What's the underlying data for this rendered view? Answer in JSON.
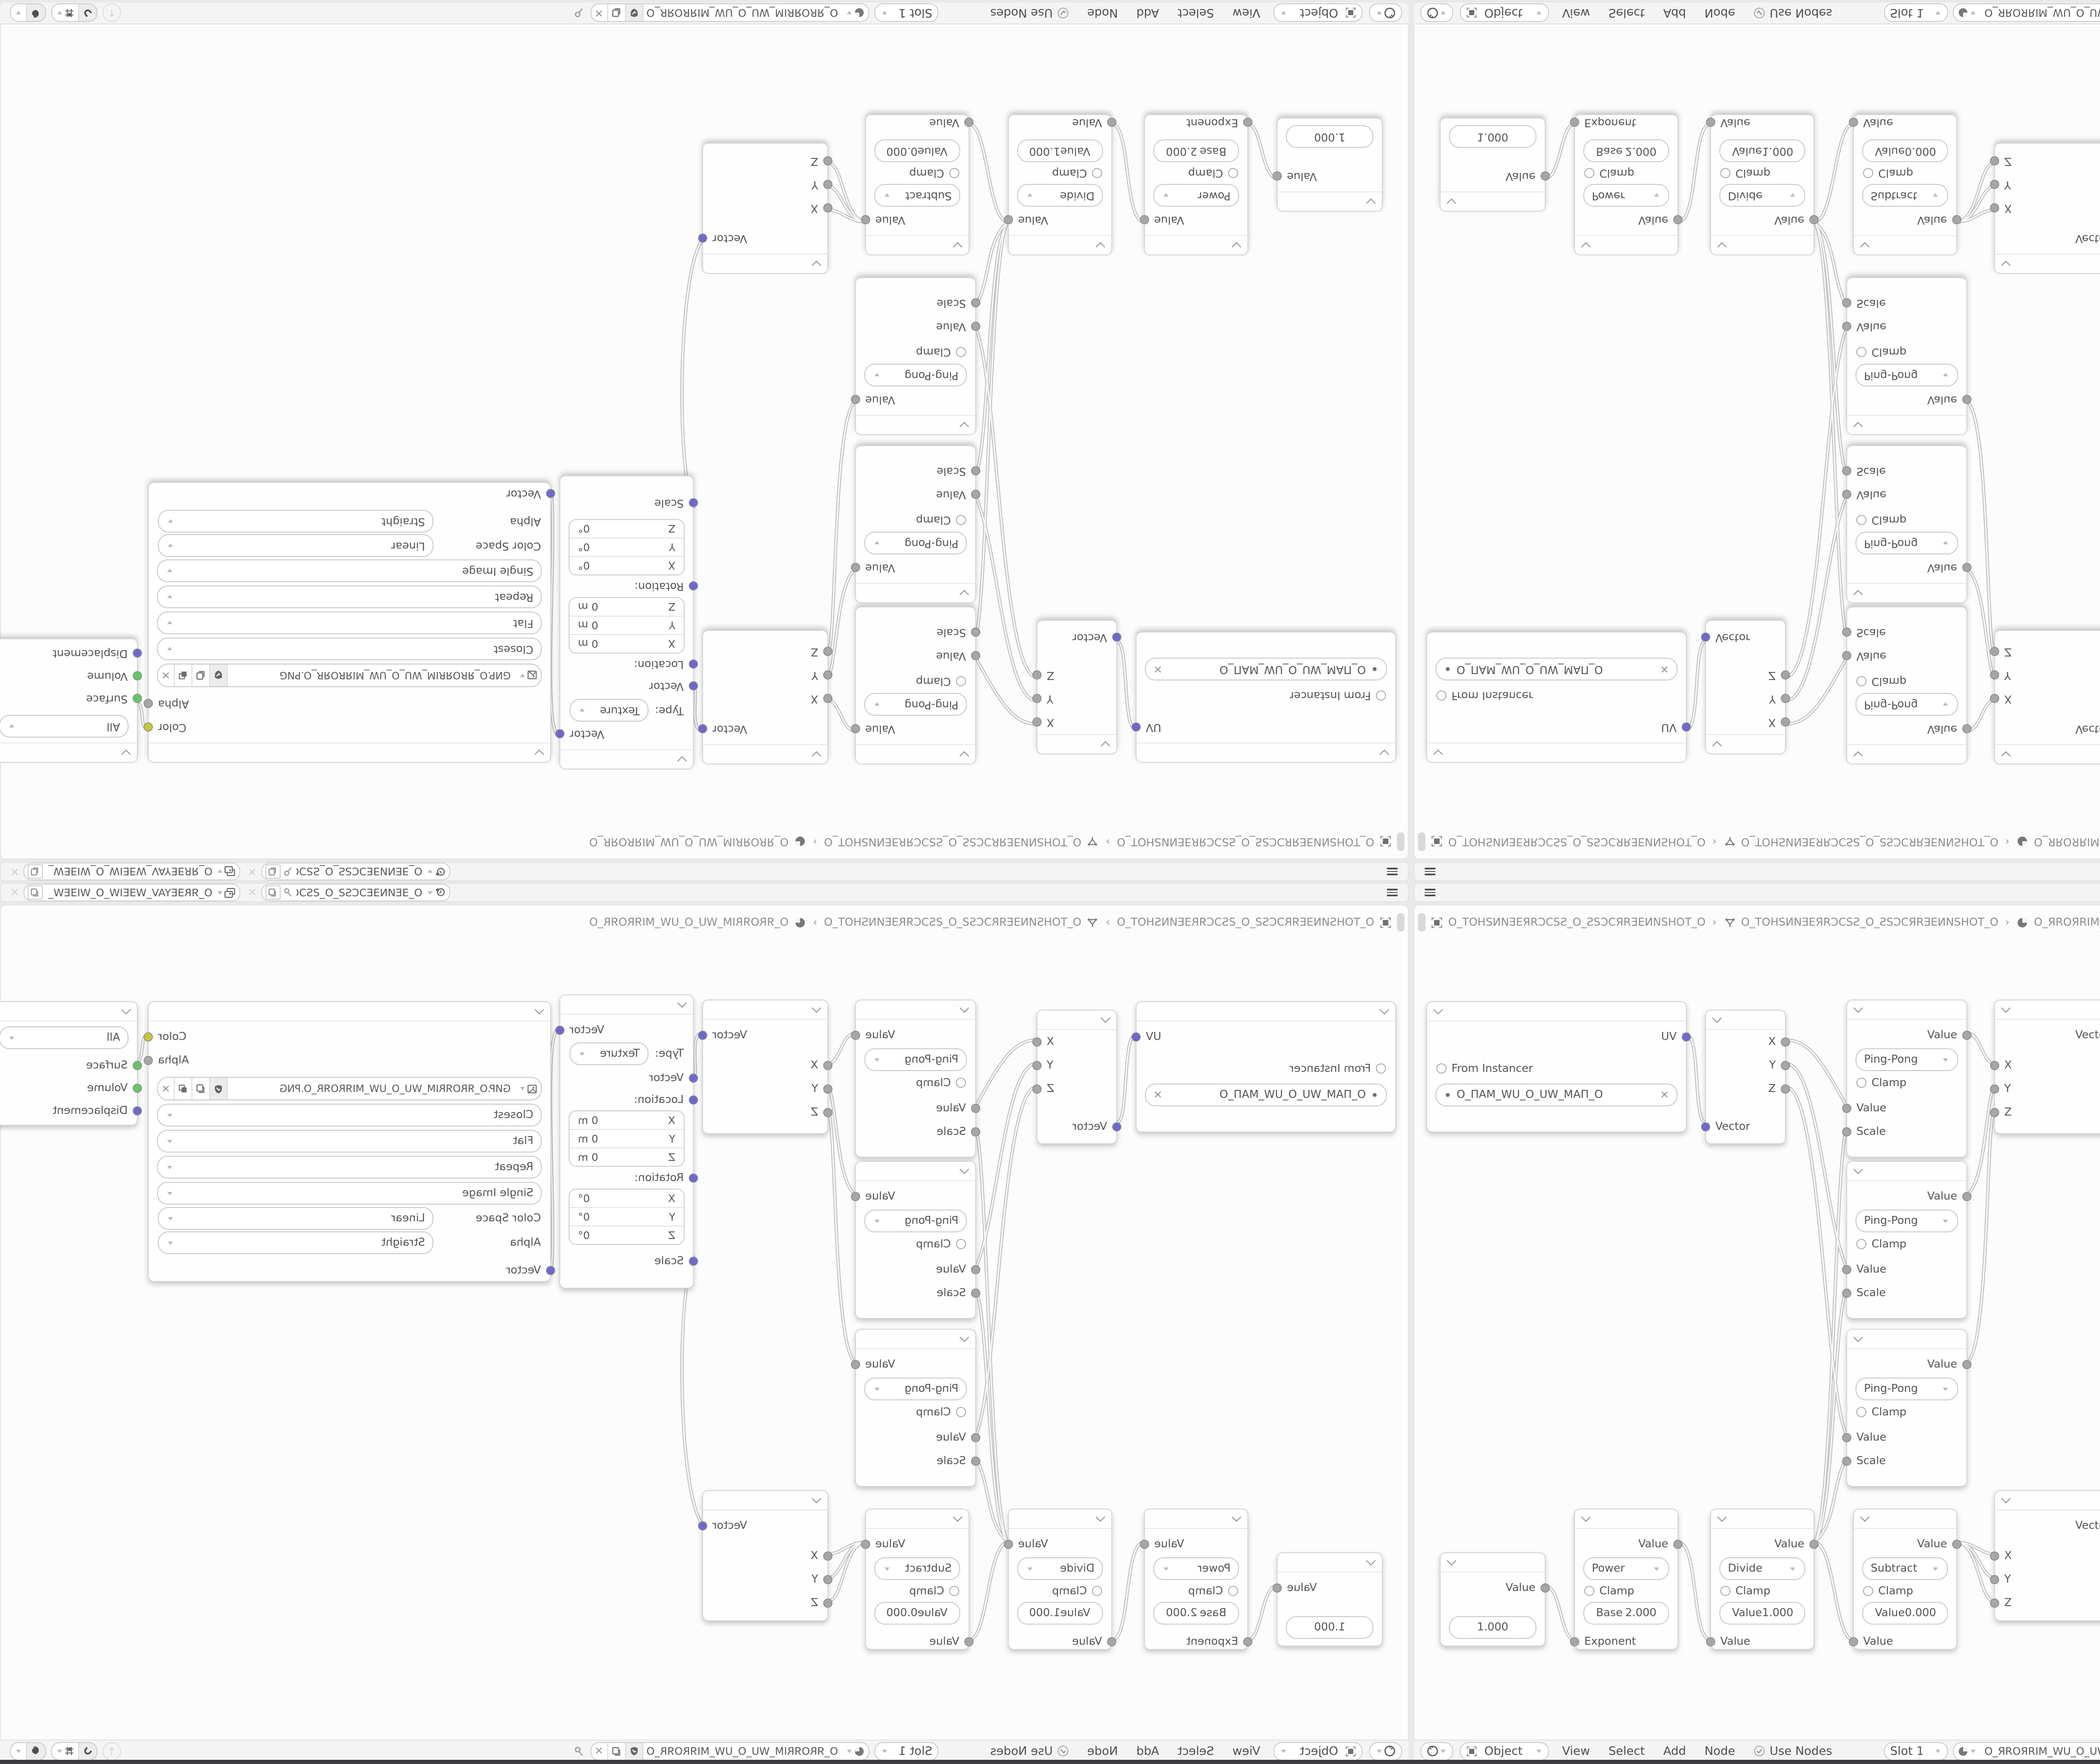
{
  "window": {
    "bottom_edge_color": "#3c3c3e"
  },
  "palette": {
    "area_background": "#e9e9ea",
    "bar_background": "#f4f4f5",
    "editor_background": "#fcfcfd",
    "node_background": "#fefefe",
    "text": "#555555",
    "socket_vector": "#6f67cf",
    "socket_value": "#a6a6a6",
    "socket_color": "#c7c832",
    "socket_shader": "#64c764",
    "wire": "#c4c4c5"
  },
  "topbar": {
    "scene_name": "O_ƎEИNƎEƆCSƧ_O_ƧSƆCƎEИ...",
    "view_layer_name": "O_ЯRƎEYAV_WƎEIW_O_WIƎEW_VAYƎEЯR_O"
  },
  "editor": {
    "breadcrumb": {
      "object_name": "O_TOHSИNƎEЯRƆCSƧ_O_ƧSƆCЯRƎEИNSHOT_O",
      "node_tree_name": "O_TOHSИNƎEЯRƆCSƧ_O_ƧSƆCЯRƎEИNSHOT_O",
      "material_name": "O_ЯROЯRIM_WU_O_UW_MIЯROЯR_O",
      "separator": "›"
    }
  },
  "header": {
    "shader_type": "Object",
    "menus": {
      "view": "View",
      "select": "Select",
      "add": "Add",
      "node": "Node"
    },
    "use_nodes_label": "Use Nodes",
    "slot_label": "Slot 1",
    "material_name": "O_ЯROЯRIM_WU_O_UW_MIЯROЯR_O"
  },
  "nodes": {
    "uv_map": {
      "output_uv": "UV",
      "from_instancer": "From Instancer",
      "uv_map_name": "O_ПAM_WU_O_UW_MAП_O"
    },
    "separate_xyz": {
      "out_x": "X",
      "out_y": "Y",
      "out_z": "Z",
      "in_vector": "Vector"
    },
    "math_pingpong": {
      "out_value": "Value",
      "operation": "Ping-Pong",
      "clamp": "Clamp",
      "in_value": "Value",
      "in_scale": "Scale"
    },
    "combine_xyz": {
      "out_vector": "Vector",
      "in_x": "X",
      "in_y": "Y",
      "in_z": "Z"
    },
    "mapping": {
      "out_vector": "Vector",
      "type_label": "Type:",
      "type_value": "Texture",
      "in_vector": "Vector",
      "location_label": "Location:",
      "rotation_label": "Rotation:",
      "scale_label": "Scale",
      "location": [
        {
          "axis": "X",
          "value": "0 m"
        },
        {
          "axis": "Y",
          "value": "0 m"
        },
        {
          "axis": "Z",
          "value": "0 m"
        }
      ],
      "rotation": [
        {
          "axis": "X",
          "value": "0°"
        },
        {
          "axis": "Y",
          "value": "0°"
        },
        {
          "axis": "Z",
          "value": "0°"
        }
      ]
    },
    "image_texture": {
      "out_color": "Color",
      "out_alpha": "Alpha",
      "image_name": "GИP.O_ЯROЯRIM_WU_O_UW_MIЯROЯR_O.PNG",
      "interpolation": "Closest",
      "projection": "Flat",
      "extension": "Repeat",
      "source": "Single Image",
      "color_space_label": "Color Space",
      "color_space_value": "Linear",
      "alpha_label": "Alpha",
      "alpha_value": "Straight",
      "in_vector": "Vector"
    },
    "material_output": {
      "target": "All",
      "in_surface": "Surface",
      "in_volume": "Volume",
      "in_displacement": "Displacement"
    },
    "value": {
      "out_value": "Value",
      "value": "1.000"
    },
    "math_power": {
      "out_value": "Value",
      "operation": "Power",
      "clamp": "Clamp",
      "field_label": "Base",
      "field_value": "2.000",
      "in_value": "Exponent"
    },
    "math_divide": {
      "out_value": "Value",
      "operation": "Divide",
      "clamp": "Clamp",
      "field_label": "Value",
      "field_value": "1.000",
      "in_value": "Value"
    },
    "math_subtract": {
      "out_value": "Value",
      "operation": "Subtract",
      "clamp": "Clamp",
      "field_label": "Value",
      "field_value": "0.000",
      "in_value": "Value"
    }
  }
}
